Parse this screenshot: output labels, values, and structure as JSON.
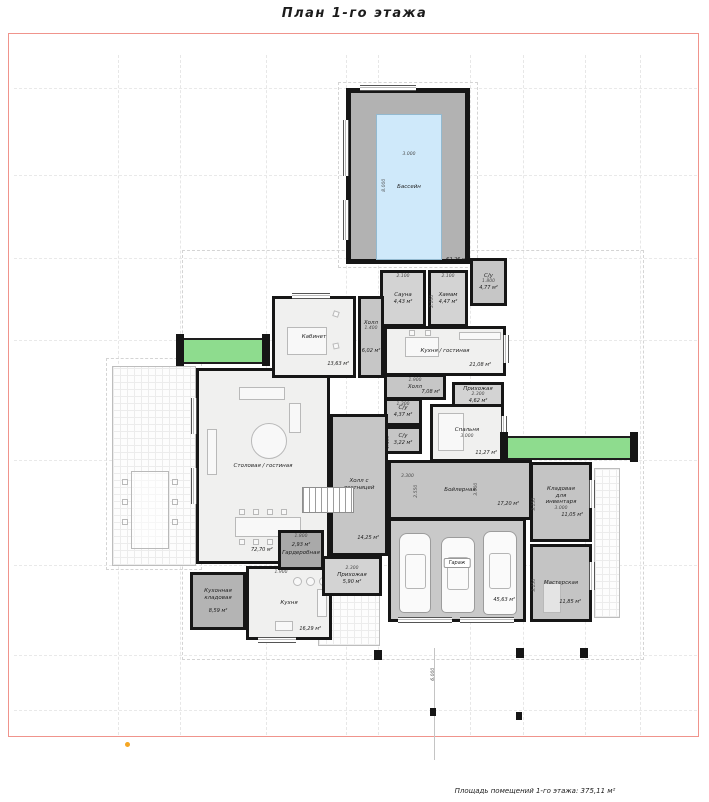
{
  "title": "План 1-го этажа",
  "footer_caption": "Площадь помещений 1-го этажа: 375,11 м²",
  "rooms": {
    "pool": {
      "name": "Бассейн",
      "area": "62,26 м²",
      "dim_w": "3.000",
      "dim_h": "8.000"
    },
    "sauna": {
      "name": "Сауна",
      "area": "4,43 м²",
      "dim": "2.100"
    },
    "hammam": {
      "name": "Хамам",
      "area": "4,47 м²",
      "dim_w": "2.100",
      "dim_h": "2.100"
    },
    "wc_top": {
      "name": "С/у",
      "area": "4,77 м²",
      "dim": "1.800"
    },
    "office": {
      "name": "Кабинет",
      "area": "13,63 м²"
    },
    "hall_small": {
      "name": "Холл",
      "area": "6,02 м²",
      "dim": "1.400"
    },
    "kitchen_living": {
      "name": "Кухня / гостиная",
      "area": "21,08 м²"
    },
    "hall_mid": {
      "name": "Холл",
      "area": "7,08 м²",
      "dim": "1.900"
    },
    "wc1": {
      "name": "С/у",
      "area": "4,37 м²",
      "dim": "1.300"
    },
    "wc2": {
      "name": "С/у",
      "area": "3,22 м²",
      "dim": "1.400"
    },
    "entry_small": {
      "name": "Прихожая",
      "area": "4,62 м²",
      "dim": "2.300"
    },
    "bedroom": {
      "name": "Спальня",
      "area": "11,27 м²",
      "dim": "3.000"
    },
    "hall_stairs": {
      "name": "Холл с лестницей",
      "area": "14,25 м²"
    },
    "dining_living": {
      "name": "Столовая / гостиная",
      "area": "72,70 м²"
    },
    "wardrobe": {
      "name": "Гардеробная",
      "area": "2,93 м²",
      "dim": "1.800"
    },
    "entry": {
      "name": "Прихожая",
      "area": "5,90 м²",
      "dim": "2.300"
    },
    "pantry": {
      "name": "Кухонная кладовая",
      "area": "8,59 м²"
    },
    "kitchen": {
      "name": "Кухня",
      "area": "16,29 м²",
      "dim": "1.900"
    },
    "boiler": {
      "name": "Бойлерная",
      "area": "17,20 м²",
      "dim_w": "3.300",
      "dim_h": "2.550",
      "dim_h2": "3.000"
    },
    "garage": {
      "name": "Гараж",
      "area": "45,63 м²"
    },
    "storage": {
      "name": "Кладовая для инвентаря",
      "area": "11,05 м²",
      "dim_w": "3.000",
      "dim_h": "3.150"
    },
    "workshop": {
      "name": "Мастерская",
      "area": "11,85 м²",
      "dim_h": "3.150"
    }
  },
  "site_dim": "6.000",
  "colors": {
    "wall": "#161616",
    "pool_water": "#cfe9fa",
    "planter_green": "#8edc8e",
    "frame_red": "#f0948c",
    "marker_orange": "#f5a623"
  }
}
